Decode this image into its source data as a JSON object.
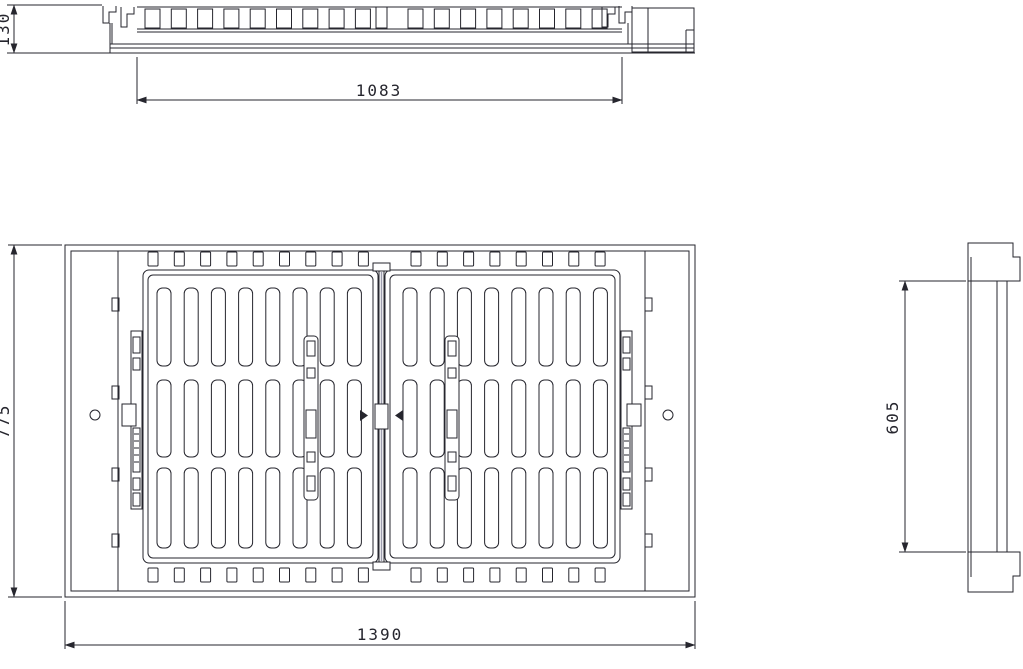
{
  "drawing": {
    "dimensions": {
      "section_height": "130",
      "grate_width": "1083",
      "overall_depth": "775",
      "overall_width": "1390",
      "side_height": "605"
    },
    "colors": {
      "line": "#26262e",
      "centerline": "#9d9dae",
      "background": "#ffffff"
    }
  }
}
